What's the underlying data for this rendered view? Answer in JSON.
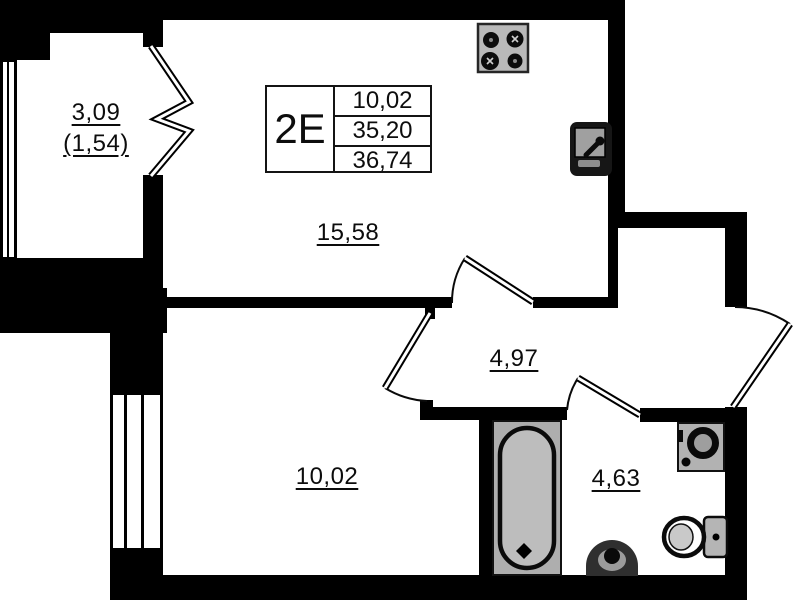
{
  "stamp": {
    "unit": "2E",
    "row1": "10,02",
    "row2": "35,20",
    "row3": "36,74"
  },
  "rooms": {
    "balcony": {
      "area": "3,09",
      "area_coefficient": "(1,54)"
    },
    "kitchen_living": {
      "area": "15,58"
    },
    "hallway": {
      "area": "4,97"
    },
    "bedroom": {
      "area": "10,02"
    },
    "bathroom": {
      "area": "4,63"
    }
  },
  "fixtures": {
    "stove": "stove-icon",
    "kitchen_sink": "kitchen-sink-icon",
    "bathtub": "bathtub-icon",
    "washing_machine": "washing-machine-icon",
    "washbasin": "washbasin-icon",
    "toilet": "toilet-icon"
  },
  "colors": {
    "wall": "#000000",
    "background": "#ffffff",
    "fixture_fill": "#b5b5b5",
    "label": "#111111"
  }
}
